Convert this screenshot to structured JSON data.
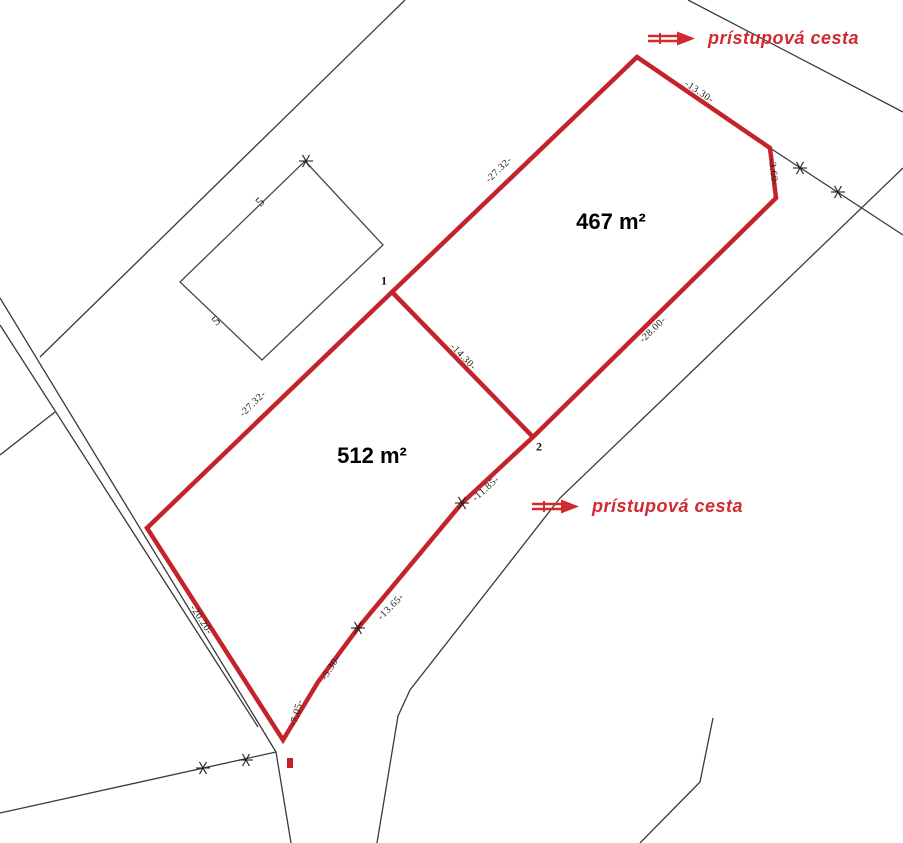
{
  "map": {
    "colors": {
      "boundary_red": "#c42429",
      "text_red": "#d22a2e",
      "line_black": "#3a3a3a",
      "building_gray": "#474747"
    },
    "area_labels": [
      {
        "text": "467 m²",
        "x": 611,
        "y": 222
      },
      {
        "text": "512 m²",
        "x": 372,
        "y": 456
      }
    ],
    "road_labels": [
      {
        "text": "prístupová cesta",
        "left": 646,
        "top": 28
      },
      {
        "text": "prístupová cesta",
        "left": 530,
        "top": 496
      }
    ],
    "dimension_labels": [
      {
        "text": "-13.30-",
        "x": 699,
        "y": 92,
        "rot": 34
      },
      {
        "text": "-3.60-",
        "x": 773,
        "y": 172,
        "rot": 83
      },
      {
        "text": "-27.32-",
        "x": 499,
        "y": 170,
        "rot": -44
      },
      {
        "text": "-27.32-",
        "x": 253,
        "y": 404,
        "rot": -44
      },
      {
        "text": "-28.00-",
        "x": 653,
        "y": 330,
        "rot": -44
      },
      {
        "text": "-14.30-",
        "x": 463,
        "y": 357,
        "rot": 46
      },
      {
        "text": "-11.85-",
        "x": 486,
        "y": 489,
        "rot": -42
      },
      {
        "text": "-13.65-",
        "x": 391,
        "y": 607,
        "rot": -45
      },
      {
        "text": "-5.30-",
        "x": 331,
        "y": 668,
        "rot": -57
      },
      {
        "text": "-7.05-",
        "x": 297,
        "y": 713,
        "rot": -75
      },
      {
        "text": "-20.20-",
        "x": 201,
        "y": 620,
        "rot": 57
      }
    ],
    "vertex_labels": [
      {
        "text": "1",
        "x": 384,
        "y": 281
      },
      {
        "text": "2",
        "x": 539,
        "y": 447
      }
    ],
    "building_marks": [
      {
        "text": "5",
        "x": 260,
        "y": 202,
        "rot": -44
      },
      {
        "text": "5",
        "x": 216,
        "y": 321,
        "rot": -40
      }
    ],
    "geometry": {
      "red_parcel_outline": [
        [
          637,
          57
        ],
        [
          770,
          148
        ],
        [
          776,
          198
        ],
        [
          533,
          437
        ],
        [
          462,
          503
        ],
        [
          358,
          628
        ],
        [
          318,
          682
        ],
        [
          283,
          740
        ],
        [
          147,
          528
        ],
        [
          392,
          292
        ]
      ],
      "red_divider": [
        [
          392,
          292
        ],
        [
          533,
          437
        ]
      ],
      "black_lines": [
        [
          [
            688,
            0
          ],
          [
            903,
            112
          ]
        ],
        [
          [
            770,
            148
          ],
          [
            903,
            235
          ]
        ],
        [
          [
            903,
            168
          ],
          [
            683,
            380
          ],
          [
            560,
            498
          ],
          [
            410,
            690
          ],
          [
            398,
            716
          ],
          [
            377,
            843
          ]
        ],
        [
          [
            405,
            0
          ],
          [
            40,
            357
          ]
        ],
        [
          [
            0,
            298
          ],
          [
            276,
            752
          ]
        ],
        [
          [
            0,
            325
          ],
          [
            258,
            727
          ]
        ],
        [
          [
            55,
            412
          ],
          [
            0,
            455
          ]
        ],
        [
          [
            276,
            752
          ],
          [
            0,
            813
          ]
        ],
        [
          [
            276,
            752
          ],
          [
            291,
            843
          ]
        ],
        [
          [
            640,
            843
          ],
          [
            700,
            782
          ],
          [
            713,
            718
          ]
        ]
      ],
      "building_outline": [
        [
          305,
          161
        ],
        [
          383,
          245
        ],
        [
          262,
          360
        ],
        [
          180,
          282
        ]
      ],
      "boundary_marker_stars": [
        [
          800,
          168
        ],
        [
          838,
          192
        ],
        [
          246,
          760
        ],
        [
          203,
          768
        ],
        [
          462,
          503
        ],
        [
          358,
          628
        ],
        [
          306,
          161
        ]
      ],
      "red_dot": {
        "x": 287,
        "y": 758,
        "w": 6,
        "h": 10
      }
    }
  }
}
